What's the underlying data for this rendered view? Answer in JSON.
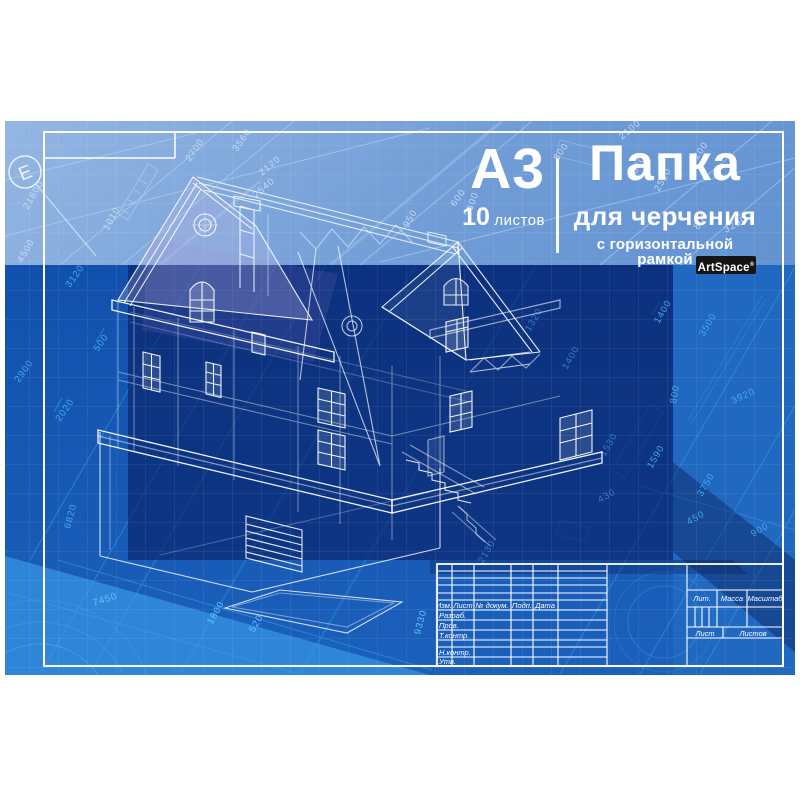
{
  "product": {
    "format": "А3",
    "sheets_count": "10",
    "sheets_word": "листов",
    "title": "Папка",
    "subtitle": "для черчения",
    "tagline": "с горизонтальной рамкой",
    "brand": "ArtSpace",
    "brand_mark": "®"
  },
  "frame_marker": "Е",
  "colors": {
    "light_band": "#7ba3d9",
    "royal": "#1a55ae",
    "azure": "#1f6ac2",
    "navy": "#123a8c",
    "lit": "#2f86d8",
    "cyan_lines": "#35a2ea",
    "badge_bg": "#141414",
    "line_white": "#ffffff"
  },
  "title_block": {
    "labels": [
      {
        "t": "Изм.",
        "x": 444,
        "y": 608,
        "a": "m"
      },
      {
        "t": "Лист",
        "x": 463,
        "y": 608,
        "a": "m"
      },
      {
        "t": "№ докум.",
        "x": 492,
        "y": 608,
        "a": "m"
      },
      {
        "t": "Подп.",
        "x": 522,
        "y": 608,
        "a": "m"
      },
      {
        "t": "Дата",
        "x": 545,
        "y": 608,
        "a": "m"
      },
      {
        "t": "Разраб.",
        "x": 439,
        "y": 618,
        "a": "s"
      },
      {
        "t": "Пров.",
        "x": 439,
        "y": 628,
        "a": "s"
      },
      {
        "t": "Т.контр.",
        "x": 439,
        "y": 638,
        "a": "s"
      },
      {
        "t": "Н.контр.",
        "x": 439,
        "y": 655,
        "a": "s"
      },
      {
        "t": "Утв.",
        "x": 439,
        "y": 664,
        "a": "s"
      },
      {
        "t": "Лит.",
        "x": 702,
        "y": 601,
        "a": "m"
      },
      {
        "t": "Масса",
        "x": 732,
        "y": 601,
        "a": "m"
      },
      {
        "t": "Масштаб",
        "x": 765,
        "y": 601,
        "a": "m"
      },
      {
        "t": "Лист",
        "x": 705,
        "y": 636,
        "a": "m"
      },
      {
        "t": "Листов",
        "x": 753,
        "y": 636,
        "a": "m"
      }
    ]
  },
  "dimensions": [
    {
      "t": "2700",
      "x": 190,
      "y": 162,
      "r": -55,
      "c": "t"
    },
    {
      "t": "3560",
      "x": 237,
      "y": 152,
      "r": -55,
      "c": "t"
    },
    {
      "t": "2120",
      "x": 262,
      "y": 176,
      "r": -40,
      "c": "t"
    },
    {
      "t": "2540",
      "x": 256,
      "y": 198,
      "r": -40,
      "c": "t"
    },
    {
      "t": "2100",
      "x": 622,
      "y": 140,
      "r": -40,
      "c": "t"
    },
    {
      "t": "800",
      "x": 558,
      "y": 161,
      "r": -55,
      "c": "t"
    },
    {
      "t": "1200",
      "x": 694,
      "y": 165,
      "r": -55,
      "c": "t"
    },
    {
      "t": "600",
      "x": 455,
      "y": 207,
      "r": -55,
      "c": "t"
    },
    {
      "t": "3600",
      "x": 470,
      "y": 217,
      "r": -70,
      "c": "t"
    },
    {
      "t": "950",
      "x": 408,
      "y": 228,
      "r": -60,
      "c": "t"
    },
    {
      "t": "1630",
      "x": 633,
      "y": 180,
      "r": -60,
      "c": "t"
    },
    {
      "t": "2520",
      "x": 659,
      "y": 192,
      "r": -60,
      "c": "t"
    },
    {
      "t": "800",
      "x": 698,
      "y": 230,
      "r": -55,
      "c": "t"
    },
    {
      "t": "3290",
      "x": 726,
      "y": 233,
      "r": -30,
      "c": "t"
    },
    {
      "t": "1010",
      "x": 108,
      "y": 231,
      "r": -60,
      "c": "t"
    },
    {
      "t": "21600",
      "x": 28,
      "y": 210,
      "r": -60,
      "c": "t"
    },
    {
      "t": "4500",
      "x": 22,
      "y": 263,
      "r": -60,
      "c": "t"
    },
    {
      "t": "3120",
      "x": 70,
      "y": 288,
      "r": -55,
      "c": "c"
    },
    {
      "t": "500",
      "x": 98,
      "y": 352,
      "r": -55,
      "c": "c"
    },
    {
      "t": "2900",
      "x": 19,
      "y": 383,
      "r": -55,
      "c": "c"
    },
    {
      "t": "2020",
      "x": 60,
      "y": 422,
      "r": -55,
      "c": "c"
    },
    {
      "t": "6820",
      "x": 70,
      "y": 529,
      "r": -75,
      "c": "c"
    },
    {
      "t": "2800",
      "x": 716,
      "y": 273,
      "r": -60,
      "c": "c"
    },
    {
      "t": "1400",
      "x": 659,
      "y": 324,
      "r": -60,
      "c": "c"
    },
    {
      "t": "3500",
      "x": 704,
      "y": 337,
      "r": -60,
      "c": "c"
    },
    {
      "t": "800",
      "x": 676,
      "y": 404,
      "r": -80,
      "c": "c"
    },
    {
      "t": "3920",
      "x": 733,
      "y": 404,
      "r": -25,
      "c": "c"
    },
    {
      "t": "1590",
      "x": 652,
      "y": 469,
      "r": -60,
      "c": "c"
    },
    {
      "t": "3750",
      "x": 702,
      "y": 497,
      "r": -60,
      "c": "c"
    },
    {
      "t": "450",
      "x": 689,
      "y": 525,
      "r": -30,
      "c": "c"
    },
    {
      "t": "900",
      "x": 753,
      "y": 537,
      "r": -30,
      "c": "c"
    },
    {
      "t": "7450",
      "x": 94,
      "y": 606,
      "r": -18,
      "c": "l"
    },
    {
      "t": "1800",
      "x": 212,
      "y": 625,
      "r": -60,
      "c": "l"
    },
    {
      "t": "520",
      "x": 254,
      "y": 633,
      "r": -60,
      "c": "l"
    },
    {
      "t": "9330",
      "x": 420,
      "y": 635,
      "r": -75,
      "c": "l"
    },
    {
      "t": "2130",
      "x": 483,
      "y": 564,
      "r": -60,
      "c": "n"
    },
    {
      "t": "1530",
      "x": 605,
      "y": 457,
      "r": -60,
      "c": "n"
    },
    {
      "t": "1320",
      "x": 530,
      "y": 332,
      "r": -60,
      "c": "n"
    },
    {
      "t": "1400",
      "x": 567,
      "y": 370,
      "r": -60,
      "c": "n"
    },
    {
      "t": "430",
      "x": 600,
      "y": 503,
      "r": -30,
      "c": "n"
    }
  ]
}
